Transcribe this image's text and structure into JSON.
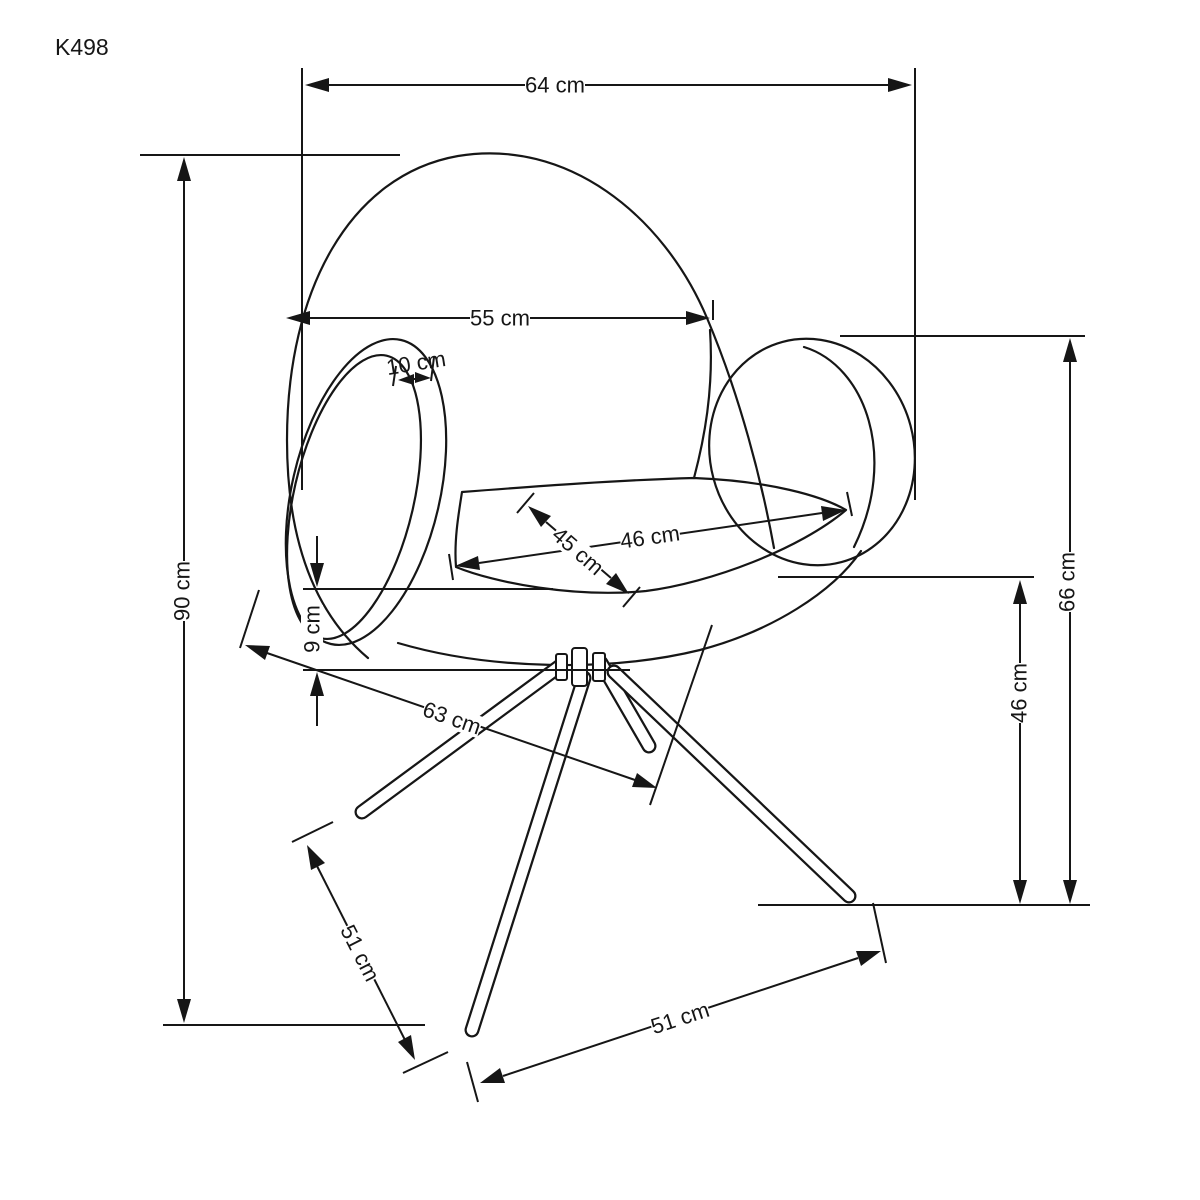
{
  "title": {
    "model": "K498"
  },
  "drawing": {
    "type": "furniture-dimension-diagram",
    "subject": "swivel armchair with round padded armrests on 4-leg pedestal base",
    "line_color": "#161616",
    "background": "#ffffff"
  },
  "dimensions": {
    "overall_width": {
      "label": "64 cm",
      "value": 64,
      "unit": "cm"
    },
    "backrest_width": {
      "label": "55 cm",
      "value": 55,
      "unit": "cm"
    },
    "armrest_rim": {
      "label": "10 cm",
      "value": 10,
      "unit": "cm"
    },
    "seat_depth": {
      "label": "45 cm",
      "value": 45,
      "unit": "cm"
    },
    "seat_width": {
      "label": "46 cm",
      "value": 46,
      "unit": "cm"
    },
    "overall_height": {
      "label": "90 cm",
      "value": 90,
      "unit": "cm"
    },
    "cushion_thickness": {
      "label": "9 cm",
      "value": 9,
      "unit": "cm"
    },
    "base_depth": {
      "label": "63 cm",
      "value": 63,
      "unit": "cm"
    },
    "armrest_height": {
      "label": "66 cm",
      "value": 66,
      "unit": "cm"
    },
    "seat_height": {
      "label": "46 cm",
      "value": 46,
      "unit": "cm"
    },
    "base_leg_span_side": {
      "label": "51 cm",
      "value": 51,
      "unit": "cm"
    },
    "base_leg_span_front": {
      "label": "51 cm",
      "value": 51,
      "unit": "cm"
    }
  }
}
